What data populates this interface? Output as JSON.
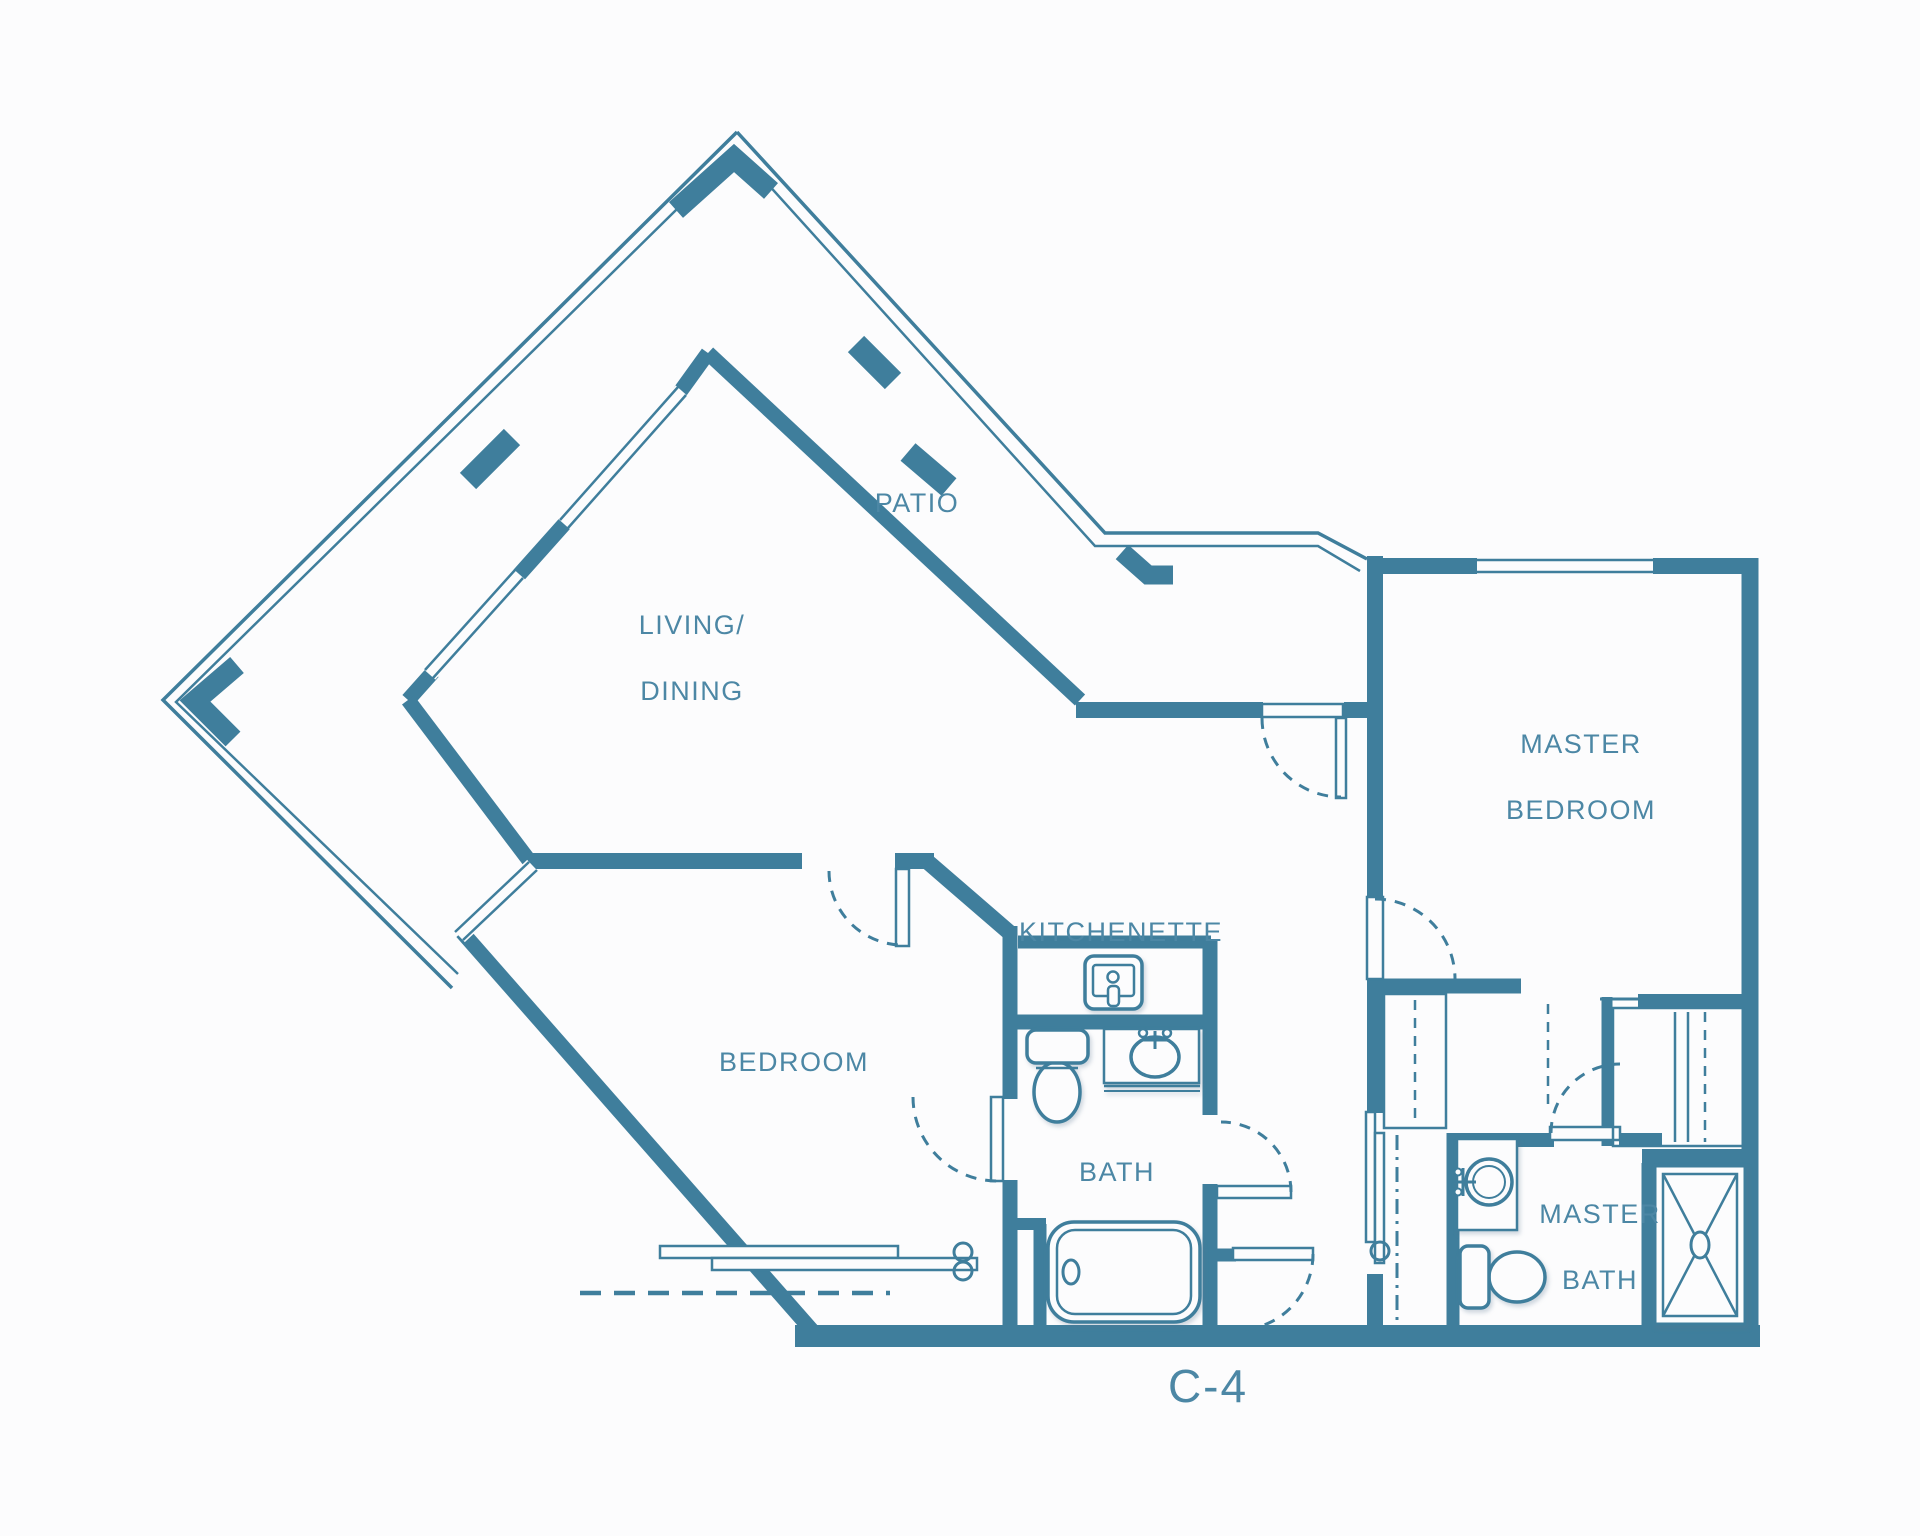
{
  "plan_code": {
    "label": "C-4"
  },
  "rooms": {
    "patio": {
      "label": "PATIO"
    },
    "living_dining": {
      "line1": "LIVING/",
      "line2": "DINING"
    },
    "master_bedroom": {
      "line1": "MASTER",
      "line2": "BEDROOM"
    },
    "bedroom": {
      "label": "BEDROOM"
    },
    "kitchenette": {
      "label": "KITCHENETTE"
    },
    "bath": {
      "label": "BATH"
    },
    "master_bath": {
      "line1": "MASTER",
      "line2": "BATH"
    }
  },
  "fixtures": [
    "kitchenette-sink-icon",
    "bath-toilet-icon",
    "bath-sink-icon",
    "bathtub-icon",
    "master-bath-sink-icon",
    "master-bath-toilet-icon",
    "shower-icon"
  ],
  "colors": {
    "wall": "#3f7e9c",
    "label_text": "#4c87a5",
    "background": "#fcfcfd"
  }
}
